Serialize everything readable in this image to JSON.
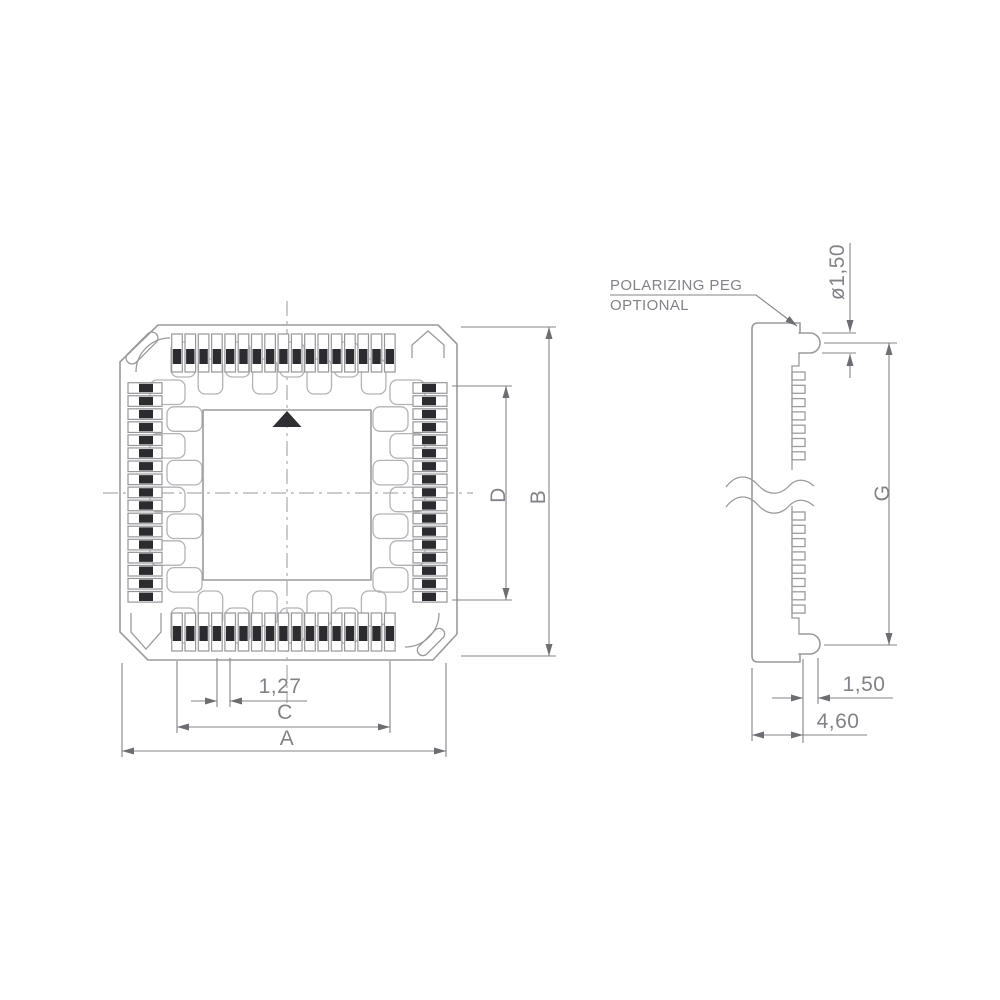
{
  "colors": {
    "line": "#9b9b9f",
    "dim_line": "#858589",
    "text": "#828288",
    "dark_fill": "#2c2c30",
    "cavity_line": "#b3b3b7"
  },
  "top_view": {
    "pins_per_side": 17,
    "cavities_per_side": 8,
    "dims": {
      "overall_width": "A",
      "overall_height": "B",
      "contact_span_width": "C",
      "contact_span_height": "D",
      "pin_pitch": "1,27"
    }
  },
  "side_view": {
    "teeth_upper": 7,
    "teeth_lower": 8,
    "note": {
      "line1": "POLARIZING PEG",
      "line2": "OPTIONAL"
    },
    "dims": {
      "peg_diameter": "ø1,50",
      "peg_to_peg_height": "G",
      "peg_width": "1,50",
      "peg_offset": "4,60"
    }
  }
}
